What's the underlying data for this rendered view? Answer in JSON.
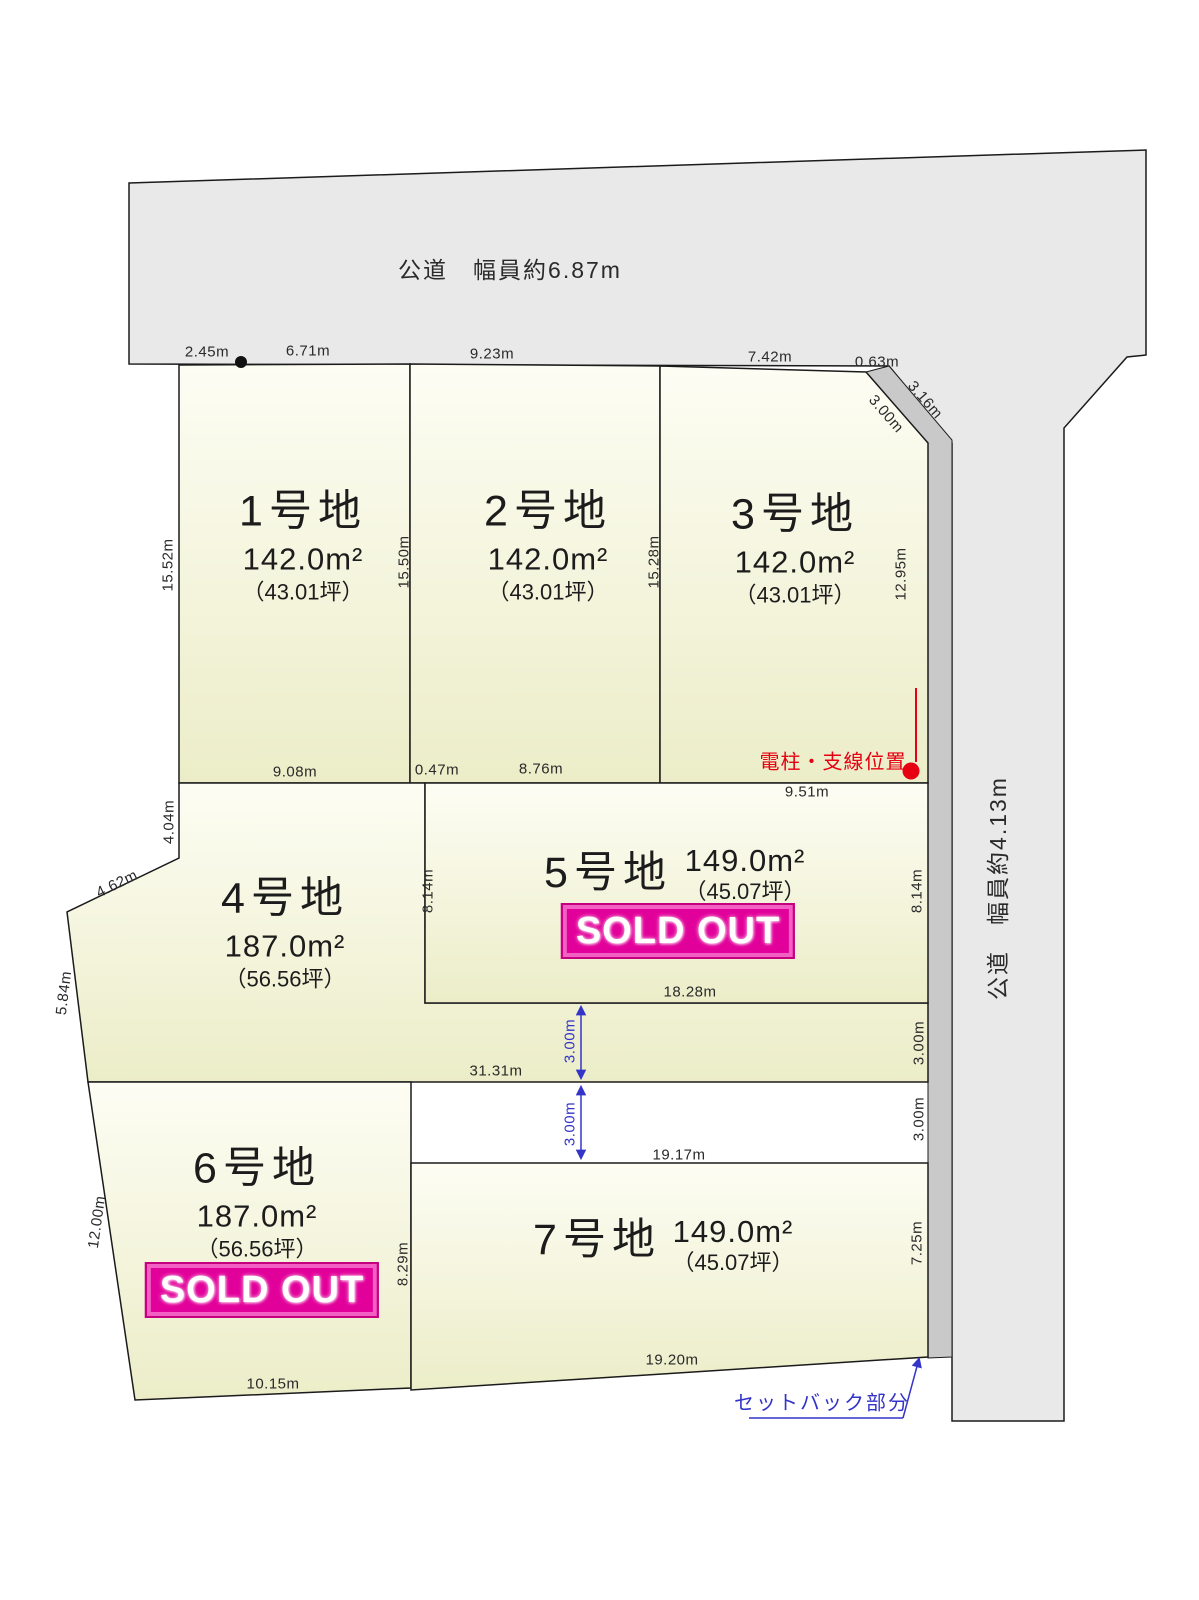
{
  "diagram": {
    "roads": {
      "top_label": "公道　幅員約6.87m",
      "right_label": "公道　幅員約4.13m"
    },
    "annotations": {
      "utility_pole": "電柱・支線位置",
      "setback": "セットバック部分"
    },
    "sold_out_label": "SOLD OUT",
    "lots": [
      {
        "name": "1号地",
        "area": "142.0m²",
        "tsubo": "（43.01坪）",
        "sold_out": false
      },
      {
        "name": "2号地",
        "area": "142.0m²",
        "tsubo": "（43.01坪）",
        "sold_out": false
      },
      {
        "name": "3号地",
        "area": "142.0m²",
        "tsubo": "（43.01坪）",
        "sold_out": false
      },
      {
        "name": "4号地",
        "area": "187.0m²",
        "tsubo": "（56.56坪）",
        "sold_out": false
      },
      {
        "name": "5号地",
        "area": "149.0m²",
        "tsubo": "（45.07坪）",
        "sold_out": true
      },
      {
        "name": "6号地",
        "area": "187.0m²",
        "tsubo": "（56.56坪）",
        "sold_out": true
      },
      {
        "name": "7号地",
        "area": "149.0m²",
        "tsubo": "（45.07坪）",
        "sold_out": false
      }
    ],
    "dimensions": {
      "road_top_seg1": "2.45m",
      "road_top_seg2": "6.71m",
      "road_top_seg3": "9.23m",
      "road_top_seg4": "7.42m",
      "road_top_seg5": "0.63m",
      "corner_cut_inner": "3.00m",
      "corner_cut_outer": "3.16m",
      "lot1_west": "15.52m",
      "lot1_east": "15.50m",
      "lot2_east": "15.28m",
      "lot3_east": "12.95m",
      "lot1_south": "9.08m",
      "jog": "0.47m",
      "lot2_south": "8.76m",
      "lot3_south": "9.51m",
      "lot4_north_west": "4.04m",
      "lot4_diagonal": "4.62m",
      "lot4_west": "5.84m",
      "lot5_west": "8.14m",
      "lot5_east": "8.14m",
      "lot5_south": "18.28m",
      "lot4_south": "31.31m",
      "access_north": "3.00m",
      "access_south": "3.00m",
      "access_north_east": "3.00m",
      "access_south_east": "3.00m",
      "lot7_north": "19.17m",
      "lot6_west": "12.00m",
      "lot7_west": "8.29m",
      "lot7_east": "7.25m",
      "lot7_south": "19.20m",
      "lot6_south": "10.15m"
    },
    "colors": {
      "road_fill": "#e9e9e9",
      "setback_strip_fill": "#c9c9c9",
      "lot_gradient_top": "#fdfdf4",
      "lot_gradient_bottom": "#ecedc8",
      "sold_out_bg": "#e2009a",
      "accent_red": "#e60012",
      "accent_blue": "#3434c8"
    }
  }
}
